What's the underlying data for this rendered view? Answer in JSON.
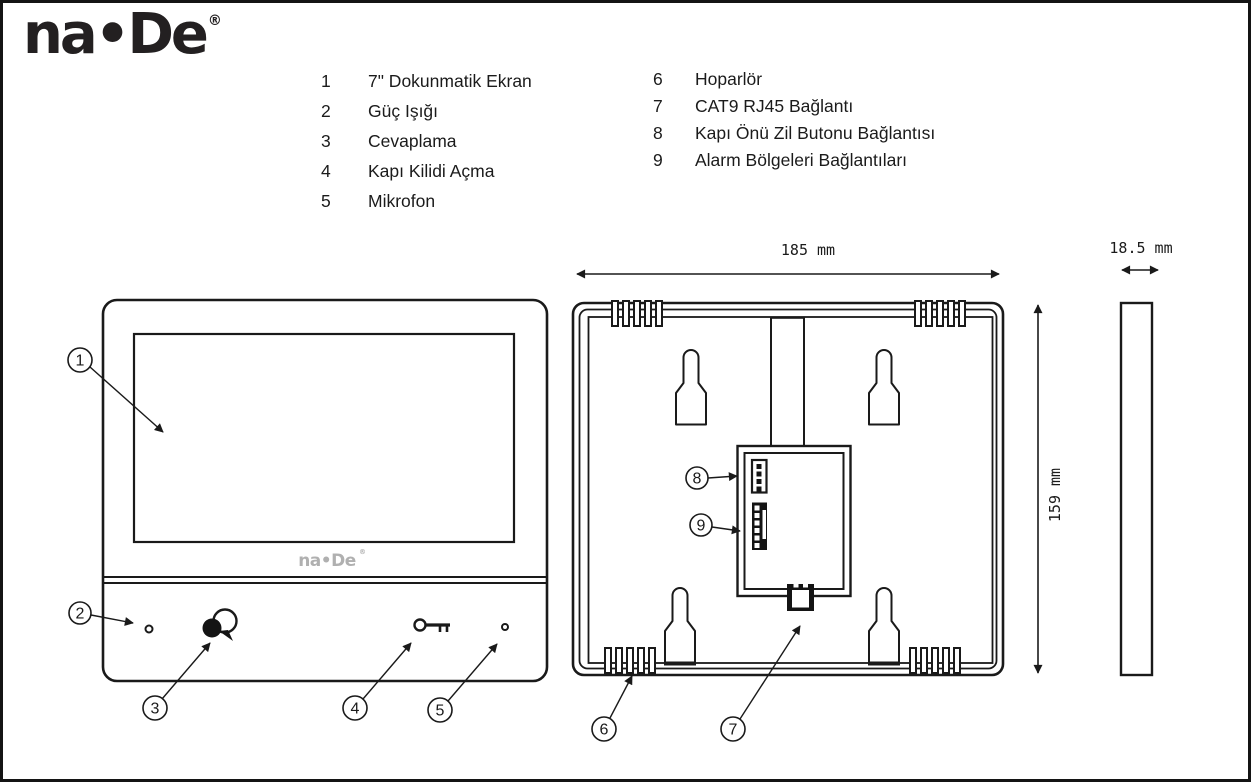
{
  "header": {
    "logo_text": "na•De",
    "logo_reg": "®"
  },
  "legend": {
    "left": [
      {
        "num": "1",
        "label": "7\" Dokunmatik Ekran"
      },
      {
        "num": "2",
        "label": "Güç Işığı"
      },
      {
        "num": "3",
        "label": "Cevaplama"
      },
      {
        "num": "4",
        "label": "Kapı Kilidi Açma"
      },
      {
        "num": "5",
        "label": "Mikrofon"
      }
    ],
    "right": [
      {
        "num": "6",
        "label": "Hoparlör"
      },
      {
        "num": "7",
        "label": "CAT9 RJ45 Bağlantı"
      },
      {
        "num": "8",
        "label": "Kapı Önü Zil Butonu Bağlantısı"
      },
      {
        "num": "9",
        "label": "Alarm Bölgeleri Bağlantıları"
      }
    ]
  },
  "front_view": {
    "device_logo": "na•De",
    "device_logo_reg": "®",
    "callouts": [
      "1",
      "2",
      "3",
      "4",
      "5"
    ],
    "icons": {
      "power_led": "led-dot",
      "answer": "speech-bubbles",
      "door_unlock": "key",
      "microphone": "mic-hole"
    }
  },
  "back_view": {
    "callouts": [
      "6",
      "7",
      "8",
      "9"
    ],
    "features": [
      "speaker-grille",
      "mounting-keyhole",
      "cable-channel",
      "terminal-module",
      "rj45-jack"
    ]
  },
  "dimensions": {
    "width_label": "185 mm",
    "height_label": "159 mm",
    "depth_label": "18.5 mm"
  },
  "colors": {
    "line": "#1a1a1a",
    "logo_gray": "#b0b0b0",
    "background": "#ffffff"
  }
}
